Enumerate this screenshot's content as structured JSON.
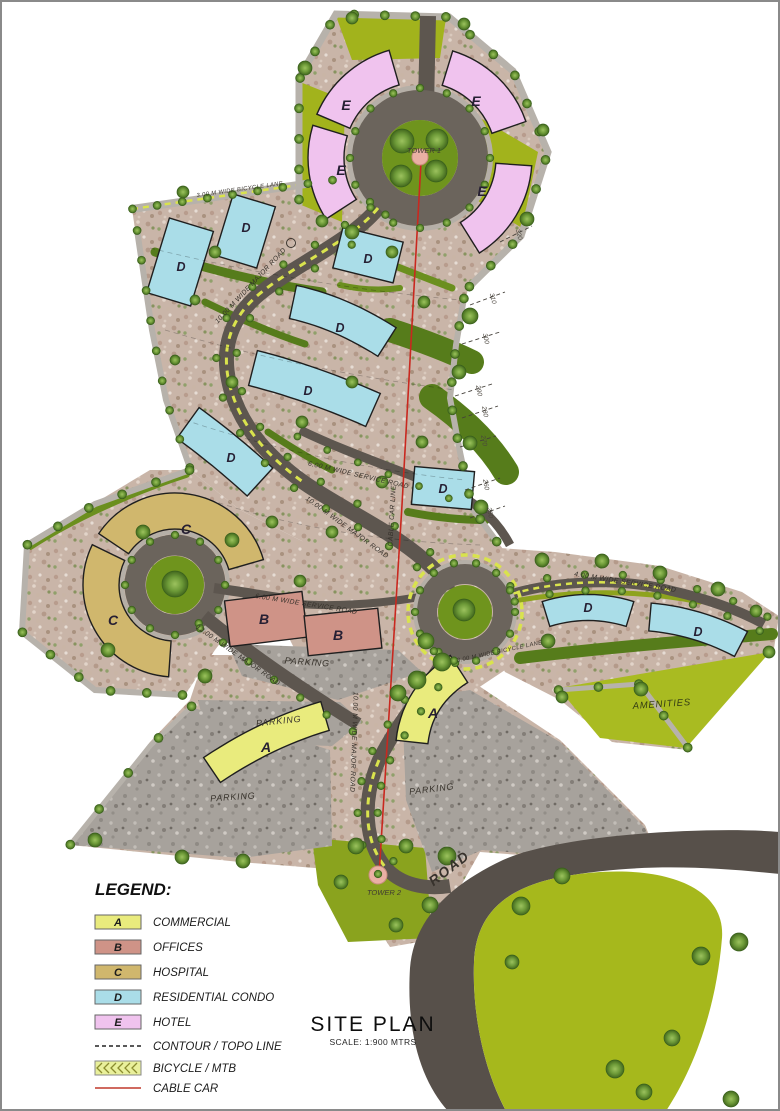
{
  "title": {
    "main": "SITE PLAN",
    "scale": "SCALE: 1:900 MTRS"
  },
  "legend": {
    "heading": "LEGEND:",
    "zones": [
      {
        "letter": "A",
        "label": "COMMERCIAL",
        "color": "#e9eb7d"
      },
      {
        "letter": "B",
        "label": "OFFICES",
        "color": "#cf9387"
      },
      {
        "letter": "C",
        "label": "HOSPITAL",
        "color": "#d0b76d"
      },
      {
        "letter": "D",
        "label": "RESIDENTIAL CONDO",
        "color": "#aadde8"
      },
      {
        "letter": "E",
        "label": "HOTEL",
        "color": "#f0c3ee"
      }
    ],
    "lines": [
      {
        "label": "CONTOUR / TOPO LINE"
      },
      {
        "label": "BICYCLE / MTB"
      },
      {
        "label": "CABLE CAR"
      }
    ]
  },
  "map": {
    "towers": {
      "tower1": "TOWER 1",
      "tower2": "TOWER 2"
    },
    "roads": {
      "major10": "10.00 M WIDE MAJOR ROAD",
      "major12": "12.00 M WIDE MAJOR ROAD",
      "service6": "6.00 M WIDE SERVICE ROAD",
      "service4": "4.00 M WIDE SERVICE ROAD",
      "bicycle": "3.00 M WIDE BICYCLE LANE",
      "cablecar": "CABLE CAR LINE",
      "road": "ROAD"
    },
    "areas": {
      "parking": "PARKING",
      "amenities": "AMENITIES"
    },
    "zone_letters": {
      "commercial": "A",
      "offices": "B",
      "hospital": "C",
      "residential": "D",
      "hotel": "E"
    },
    "contours": [
      "320",
      "310",
      "300",
      "290",
      "280",
      "270",
      "260",
      "250"
    ]
  },
  "colors": {
    "terrain": "#c9b5a8",
    "road_dark": "#5d564f",
    "road_light": "#b7b2ab",
    "olive": "#a2b31c",
    "green_dark": "#567c1b",
    "cable_red": "#c9281f",
    "bike_yellow": "#d9e34d"
  }
}
